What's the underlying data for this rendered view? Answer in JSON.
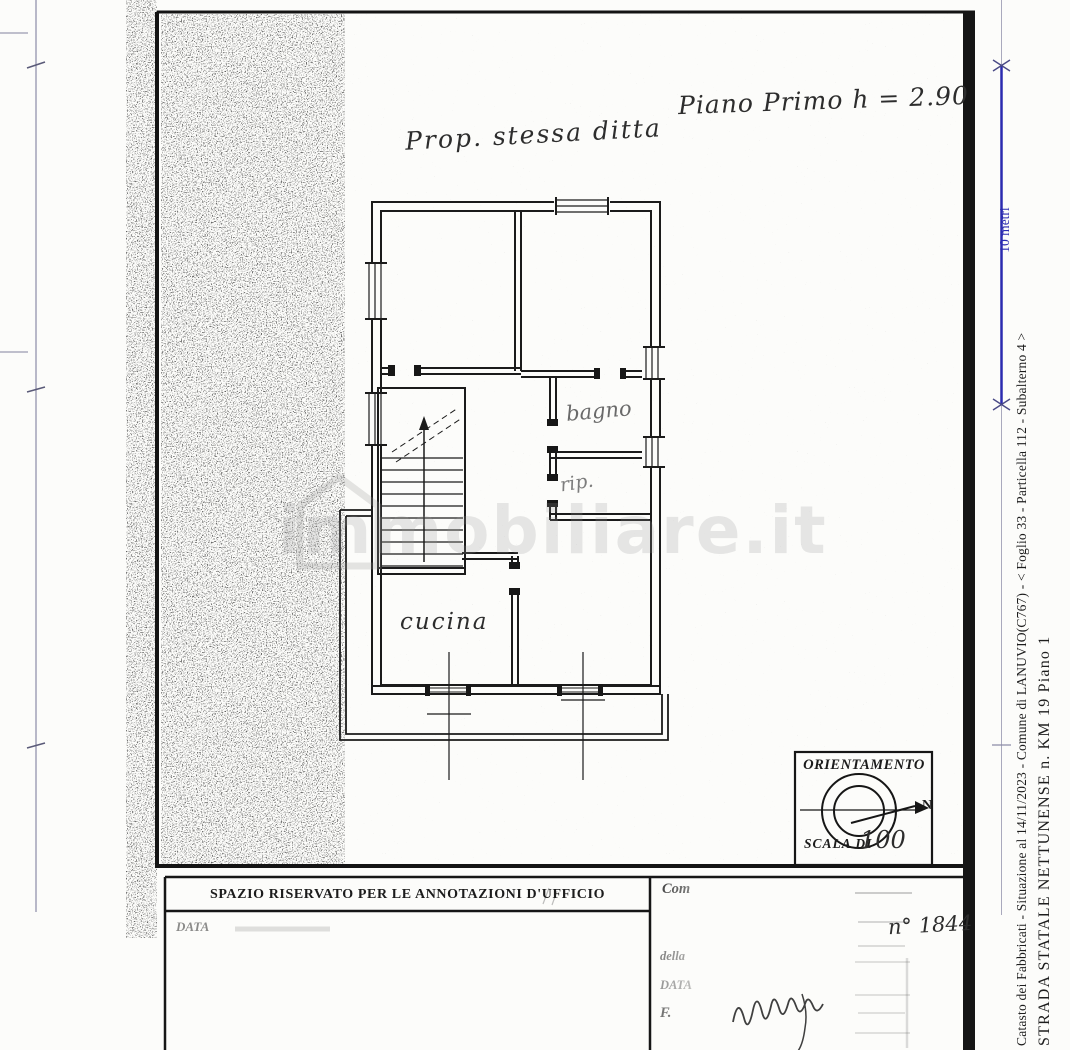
{
  "plan": {
    "note_property": "Prop. stessa ditta",
    "note_floor": "Piano Primo h = 2.90",
    "room_bagno": "bagno",
    "room_rip": "rip.",
    "room_cucina": "cucina"
  },
  "orientation": {
    "title": "ORIENTAMENTO",
    "north": "N",
    "scale_label": "SCALA DI",
    "scale_value": "100"
  },
  "scale_bar": {
    "label": "10 metri",
    "color": "#2b2bb0"
  },
  "margin": {
    "line1": "Catasto dei Fabbricati - Situazione al 14/11/2023 - Comune di LANUVIO(C767) - < Foglio 33 - Particella 112 - Subalterno 4 >",
    "line2": "STRADA STATALE NETTUNENSE n. KM 19 Piano 1"
  },
  "office": {
    "title": "SPAZIO RISERVATO PER LE ANNOTAZIONI D'UFFICIO",
    "date_label": "DATA"
  },
  "panel": {
    "compiler": "Com",
    "della": "della",
    "date": "DATA",
    "firma": "F.",
    "number": "n° 1844"
  },
  "watermark": {
    "text": "immobiliare.it"
  }
}
